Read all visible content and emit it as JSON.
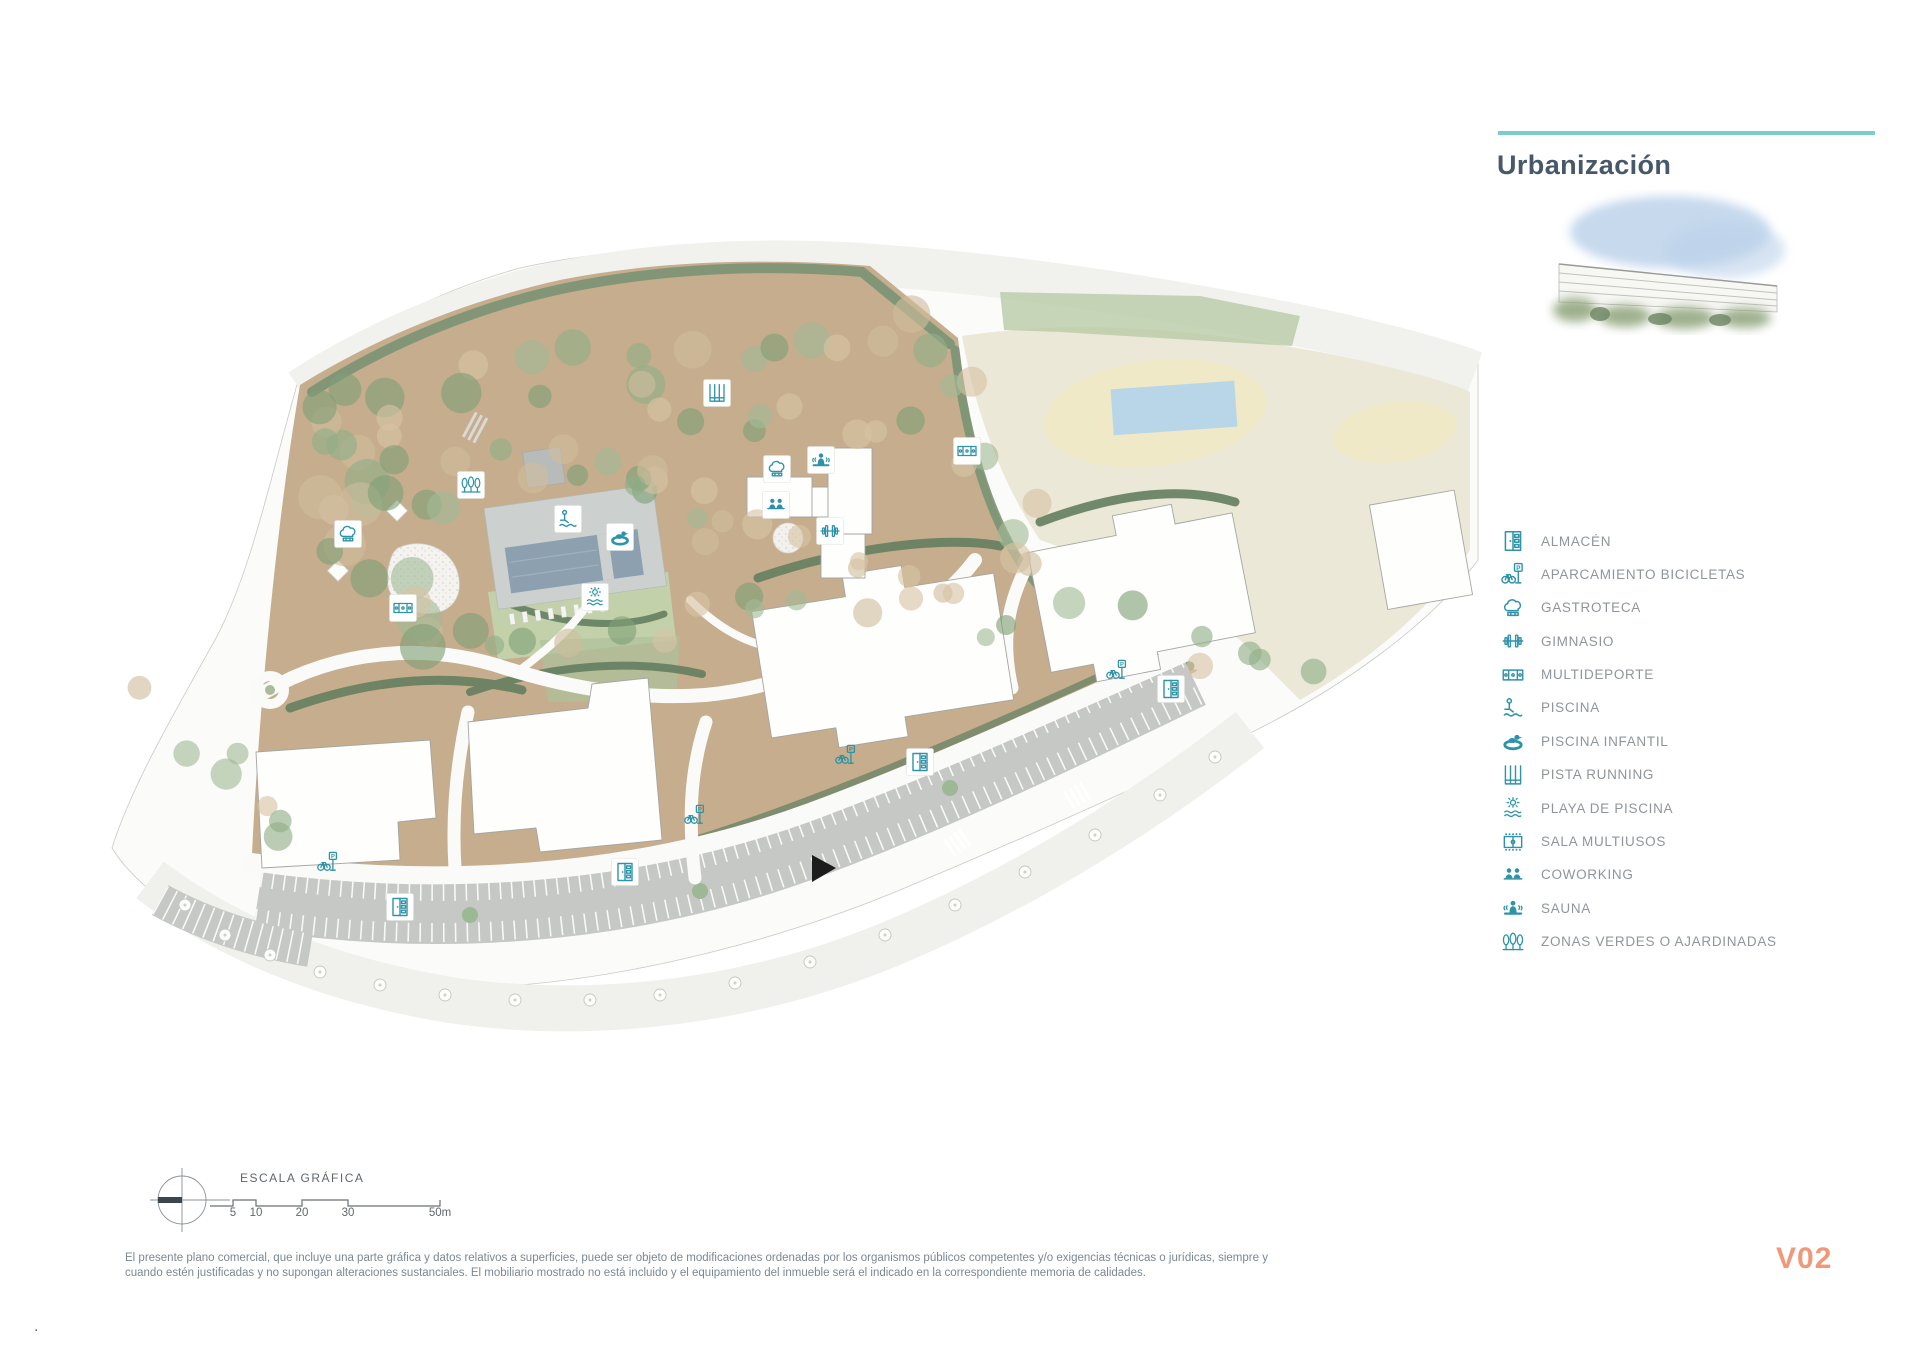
{
  "header": {
    "title": "Urbanización",
    "accent_color": "#7ccccd",
    "title_color": "#46586a"
  },
  "legend": {
    "icon_color": "#2e93a8",
    "text_color": "#8f959b",
    "items": [
      {
        "icon": "almacen-icon",
        "label": "ALMACÉN"
      },
      {
        "icon": "bike-parking-icon",
        "label": "APARCAMIENTO BICICLETAS"
      },
      {
        "icon": "gastroteca-icon",
        "label": "GASTROTECA"
      },
      {
        "icon": "gimnasio-icon",
        "label": "GIMNASIO"
      },
      {
        "icon": "multideporte-icon",
        "label": "MULTIDEPORTE"
      },
      {
        "icon": "piscina-icon",
        "label": "PISCINA"
      },
      {
        "icon": "piscina-infantil-icon",
        "label": "PISCINA INFANTIL"
      },
      {
        "icon": "pista-running-icon",
        "label": "PISTA RUNNING"
      },
      {
        "icon": "playa-piscina-icon",
        "label": "PLAYA DE PISCINA"
      },
      {
        "icon": "sala-multiusos-icon",
        "label": "SALA MULTIUSOS"
      },
      {
        "icon": "coworking-icon",
        "label": "COWORKING"
      },
      {
        "icon": "sauna-icon",
        "label": "SAUNA"
      },
      {
        "icon": "zonas-verdes-icon",
        "label": "ZONAS VERDES O AJARDINADAS"
      }
    ]
  },
  "scale_bar": {
    "title": "ESCALA GRÁFICA",
    "tick_labels": [
      "5",
      "10",
      "20",
      "30",
      "50m"
    ]
  },
  "footer": {
    "disclaimer_line1": "El presente plano comercial, que incluye una parte gráfica y datos relativos a superficies, puede ser objeto de modificaciones ordenadas por los organismos públicos competentes y/o exigencias técnicas o jurídicas, siempre y",
    "disclaimer_line2": "cuando estén justificadas y no supongan alteraciones sustanciales. El mobiliario mostrado no está incluido y el equipamiento del inmueble será el indicado en la correspondiente memoria de calidades.",
    "version": "V02",
    "version_color": "#f0997a",
    "corner_mark": "."
  },
  "map": {
    "markers": [
      {
        "kind": "zonas-verdes",
        "x": 471,
        "y": 485,
        "badge": true
      },
      {
        "kind": "gastroteca",
        "x": 348,
        "y": 534,
        "badge": true
      },
      {
        "kind": "multideporte",
        "x": 403,
        "y": 608,
        "badge": true
      },
      {
        "kind": "piscina",
        "x": 568,
        "y": 519,
        "badge": true
      },
      {
        "kind": "piscina-infantil",
        "x": 620,
        "y": 537,
        "badge": true
      },
      {
        "kind": "playa-piscina",
        "x": 595,
        "y": 597,
        "badge": true
      },
      {
        "kind": "pista-running",
        "x": 717,
        "y": 393,
        "badge": true
      },
      {
        "kind": "sauna",
        "x": 821,
        "y": 460,
        "badge": true
      },
      {
        "kind": "gastroteca",
        "x": 777,
        "y": 469,
        "badge": true
      },
      {
        "kind": "coworking",
        "x": 776,
        "y": 505,
        "badge": true
      },
      {
        "kind": "gimnasio",
        "x": 830,
        "y": 531,
        "badge": true
      },
      {
        "kind": "multideporte",
        "x": 967,
        "y": 451,
        "badge": true
      },
      {
        "kind": "almacen",
        "x": 400,
        "y": 907,
        "badge": true
      },
      {
        "kind": "almacen",
        "x": 625,
        "y": 872,
        "badge": true
      },
      {
        "kind": "almacen",
        "x": 920,
        "y": 762,
        "badge": true
      },
      {
        "kind": "almacen",
        "x": 1171,
        "y": 689,
        "badge": true
      },
      {
        "kind": "bike-parking",
        "x": 328,
        "y": 862,
        "badge": false
      },
      {
        "kind": "bike-parking",
        "x": 695,
        "y": 815,
        "badge": false
      },
      {
        "kind": "bike-parking",
        "x": 846,
        "y": 755,
        "badge": false
      },
      {
        "kind": "bike-parking",
        "x": 1117,
        "y": 670,
        "badge": false
      }
    ]
  }
}
